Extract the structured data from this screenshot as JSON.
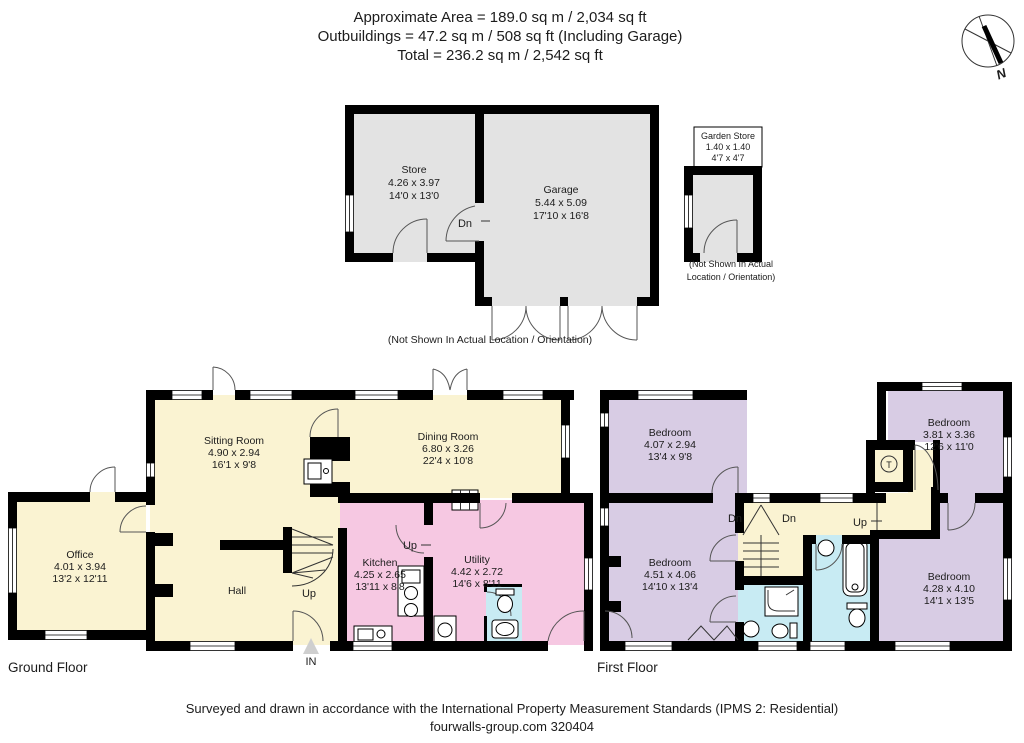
{
  "header": {
    "line1": "Approximate Area = 189.0 sq m / 2,034 sq ft",
    "line2": "Outbuildings = 47.2 sq m / 508 sq ft (Including Garage)",
    "line3": "Total = 236.2 sq m / 2,542 sq ft"
  },
  "compass": {
    "north": "N"
  },
  "outbuildings": {
    "store": {
      "name": "Store",
      "metric": "4.26 x 3.97",
      "imperial": "14'0 x 13'0"
    },
    "garage": {
      "name": "Garage",
      "metric": "5.44 x 5.09",
      "imperial": "17'10 x 16'8"
    },
    "stairs_label": "Dn",
    "note": "(Not Shown In Actual Location / Orientation)",
    "garden_store": {
      "name": "Garden Store",
      "metric": "1.40 x 1.40",
      "imperial": "4'7 x 4'7",
      "note_line1": "(Not Shown In Actual",
      "note_line2": "Location / Orientation)"
    }
  },
  "ground_floor": {
    "title": "Ground Floor",
    "sitting_room": {
      "name": "Sitting Room",
      "metric": "4.90 x 2.94",
      "imperial": "16'1 x 9'8"
    },
    "dining_room": {
      "name": "Dining Room",
      "metric": "6.80 x 3.26",
      "imperial": "22'4 x 10'8"
    },
    "office": {
      "name": "Office",
      "metric": "4.01 x 3.94",
      "imperial": "13'2 x 12'11"
    },
    "kitchen": {
      "name": "Kitchen",
      "metric": "4.25 x 2.65",
      "imperial": "13'11 x 8'8"
    },
    "utility": {
      "name": "Utility",
      "metric": "4.42 x 2.72",
      "imperial": "14'6 x 8'11"
    },
    "hall": "Hall",
    "stairs_up_hall": "Up",
    "stairs_up_kitchen": "Up",
    "entrance": "IN"
  },
  "first_floor": {
    "title": "First Floor",
    "bedroom_top_left": {
      "name": "Bedroom",
      "metric": "4.07 x 2.94",
      "imperial": "13'4 x 9'8"
    },
    "bedroom_bottom_left": {
      "name": "Bedroom",
      "metric": "4.51 x 4.06",
      "imperial": "14'10 x 13'4"
    },
    "bedroom_top_right": {
      "name": "Bedroom",
      "metric": "3.81 x 3.36",
      "imperial": "12'6 x 11'0"
    },
    "bedroom_bottom_right": {
      "name": "Bedroom",
      "metric": "4.28 x 4.10",
      "imperial": "14'1 x 13'5"
    },
    "stairs_down_left": "Dn",
    "stairs_down_right": "Dn",
    "stairs_up_attic": "Up",
    "tank": "T"
  },
  "footer": {
    "line1": "Surveyed and drawn in accordance with the International Property Measurement Standards (IPMS 2: Residential)",
    "line2": "fourwalls-group.com 320404"
  },
  "colors": {
    "wall": "#000000",
    "living_cream": "#FAF3D2",
    "kitchen_pink": "#F6C8E2",
    "bedroom_lavender": "#D8CCE4",
    "bathroom_cyan": "#C8EBF3",
    "outbuilding_gray": "#E3E3E3"
  }
}
